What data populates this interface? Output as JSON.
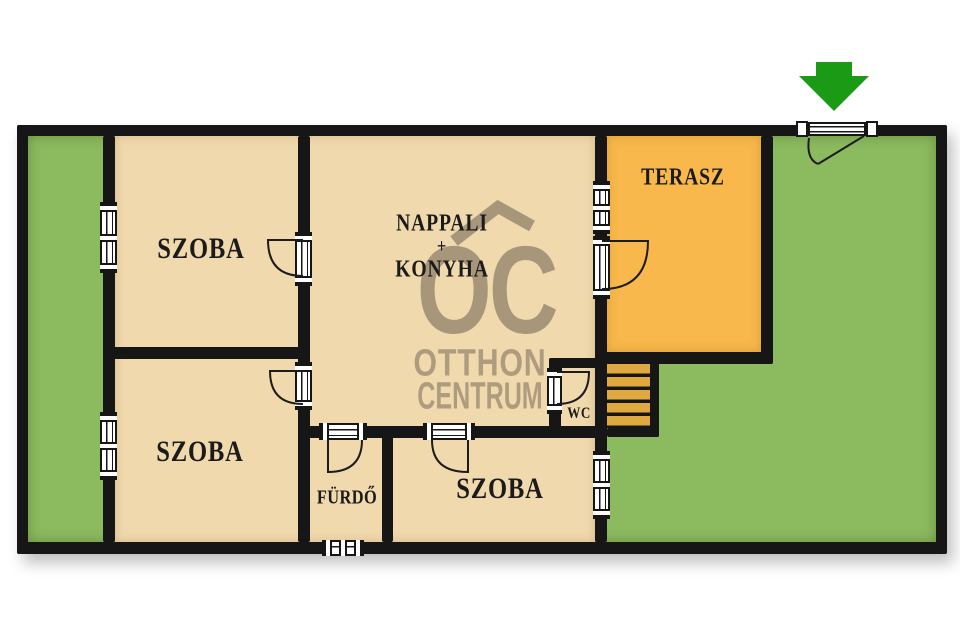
{
  "floorplan": {
    "rooms": {
      "szoba_top_left": {
        "label": "SZOBA"
      },
      "szoba_bottom_left": {
        "label": "SZOBA"
      },
      "szoba_bottom_center": {
        "label": "SZOBA"
      },
      "nappali_konyha": {
        "line1": "NAPPALI",
        "line2": "+",
        "line3": "KONYHA"
      },
      "terasz": {
        "label": "TERASZ"
      },
      "furdo": {
        "label": "FÜRDŐ"
      },
      "wc": {
        "label": "WC"
      }
    },
    "watermark": {
      "logo": "OC",
      "brand_line1": "OTTHON",
      "brand_line2": "CENTRUM"
    },
    "symbols": {
      "entrance_arrow": "green-down-arrow-at-gate"
    },
    "colors": {
      "wall": "#161616",
      "room_fill": "#f0d9ad",
      "terrace_fill": "#f8b84b",
      "garden_fill": "#8cba5f",
      "steps_fill": "#e0a93f",
      "arrow_green": "#1b9a16",
      "watermark_tint": "#8a7c65",
      "background": "#ffffff"
    }
  }
}
